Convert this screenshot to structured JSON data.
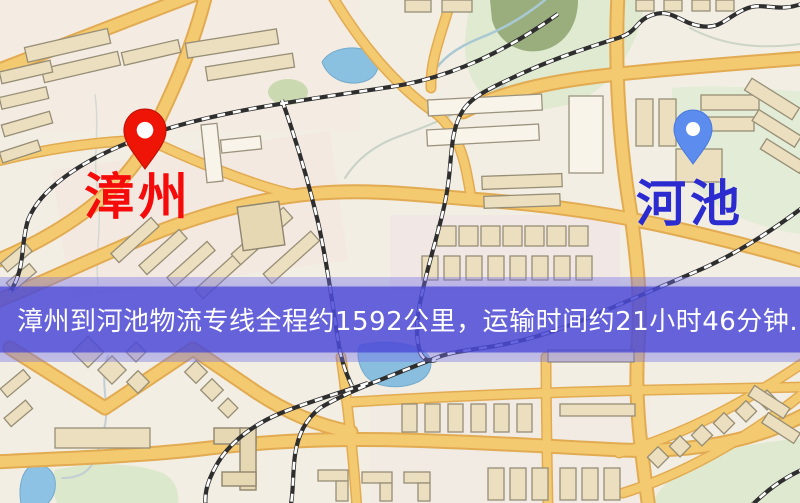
{
  "banner": {
    "text": "漳州到河池物流专线全程约1592公里，运输时间约21小时46分钟.",
    "background_color": "#4c4ad8",
    "text_color": "#ffffff"
  },
  "route": {
    "origin": "漳州",
    "destination": "河池",
    "distance": "约1592公里",
    "duration": "约21小时46分钟"
  },
  "markers": {
    "origin": {
      "label": "漳州",
      "icon": "location-pin-icon",
      "pin_color": "#ee1506",
      "label_color": "#f60b0b"
    },
    "destination": {
      "label": "河池",
      "icon": "location-pin-icon",
      "pin_color": "#5b8cee",
      "label_color": "#2b2bd0"
    }
  },
  "map": {
    "colors": {
      "background": "#f2eee3",
      "road": "#f3ca70",
      "road_casing": "#e2ab52",
      "water": "#8ac0e0",
      "park": "#e0ead0",
      "forest": "#94a875",
      "building": "#ecdfc0",
      "railway": "#2e2e2e"
    }
  }
}
